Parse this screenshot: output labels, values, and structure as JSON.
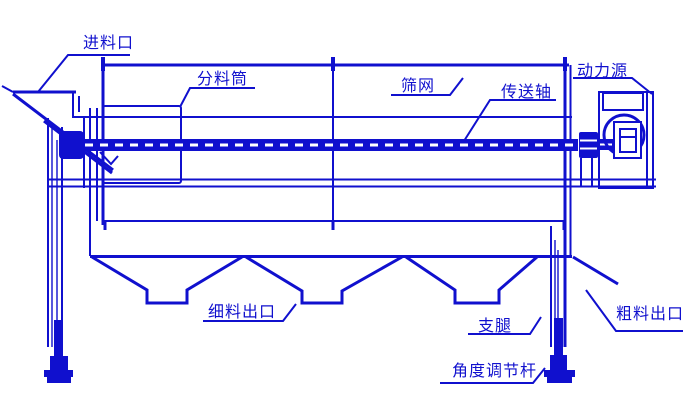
{
  "colors": {
    "line": "#1010ce",
    "background": "#ffffff"
  },
  "labels": {
    "feed_inlet": {
      "text": "进料口"
    },
    "distribution_cylinder": {
      "text": "分料筒"
    },
    "screen_mesh": {
      "text": "筛网"
    },
    "transmission_shaft": {
      "text": "传送轴"
    },
    "power_source": {
      "text": "动力源"
    },
    "fine_outlet": {
      "text": "细料出口"
    },
    "support_leg": {
      "text": "支腿"
    },
    "coarse_outlet": {
      "text": "粗料出口"
    },
    "angle_rod": {
      "text": "角度调节杆"
    }
  }
}
